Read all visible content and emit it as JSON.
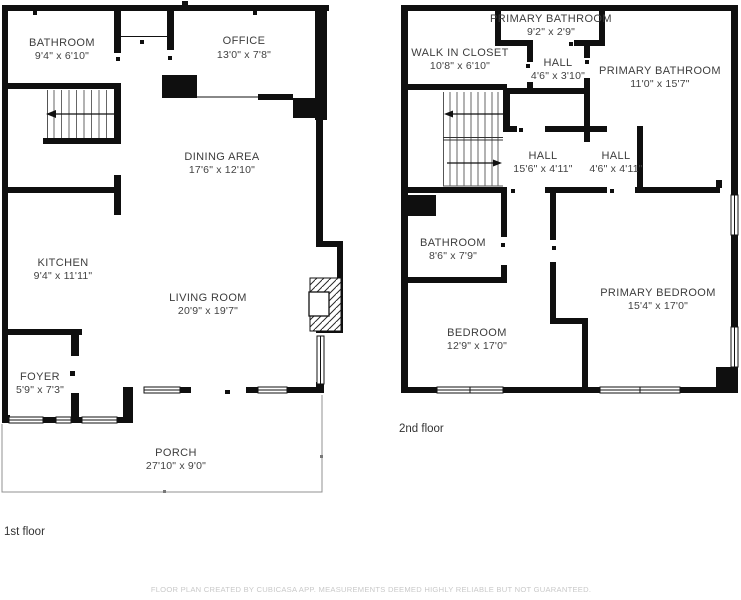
{
  "floors": [
    {
      "label": "1st floor",
      "rooms": [
        {
          "name": "BATHROOM",
          "dims": "9'4\" x 6'10\""
        },
        {
          "name": "OFFICE",
          "dims": "13'0\" x 7'8\""
        },
        {
          "name": "DINING AREA",
          "dims": "17'6\" x 12'10\""
        },
        {
          "name": "KITCHEN",
          "dims": "9'4\" x 11'11\""
        },
        {
          "name": "LIVING ROOM",
          "dims": "20'9\" x 19'7\""
        },
        {
          "name": "FOYER",
          "dims": "5'9\" x 7'3\""
        },
        {
          "name": "PORCH",
          "dims": "27'10\" x 9'0\""
        }
      ]
    },
    {
      "label": "2nd floor",
      "rooms": [
        {
          "name": "PRIMARY BATHROOM",
          "dims": "9'2\" x 2'9\""
        },
        {
          "name": "WALK IN CLOSET",
          "dims": "10'8\" x 6'10\""
        },
        {
          "name": "HALL",
          "dims": "4'6\" x 3'10\""
        },
        {
          "name": "PRIMARY BATHROOM",
          "dims": "11'0\" x 15'7\""
        },
        {
          "name": "HALL",
          "dims": "15'6\" x 4'11\""
        },
        {
          "name": "HALL",
          "dims": "4'6\" x 4'11\""
        },
        {
          "name": "BATHROOM",
          "dims": "8'6\" x 7'9\""
        },
        {
          "name": "BEDROOM",
          "dims": "12'9\" x 17'0\""
        },
        {
          "name": "PRIMARY BEDROOM",
          "dims": "15'4\" x 17'0\""
        }
      ]
    }
  ],
  "footer": "FLOOR PLAN CREATED BY CUBICASA APP. MEASUREMENTS DEEMED HIGHLY RELIABLE BUT NOT GUARANTEED.",
  "colors": {
    "wall": "#0f0f0f",
    "text": "#3d3d3d",
    "porch_line": "#909090",
    "footer": "#c9c9c9"
  }
}
